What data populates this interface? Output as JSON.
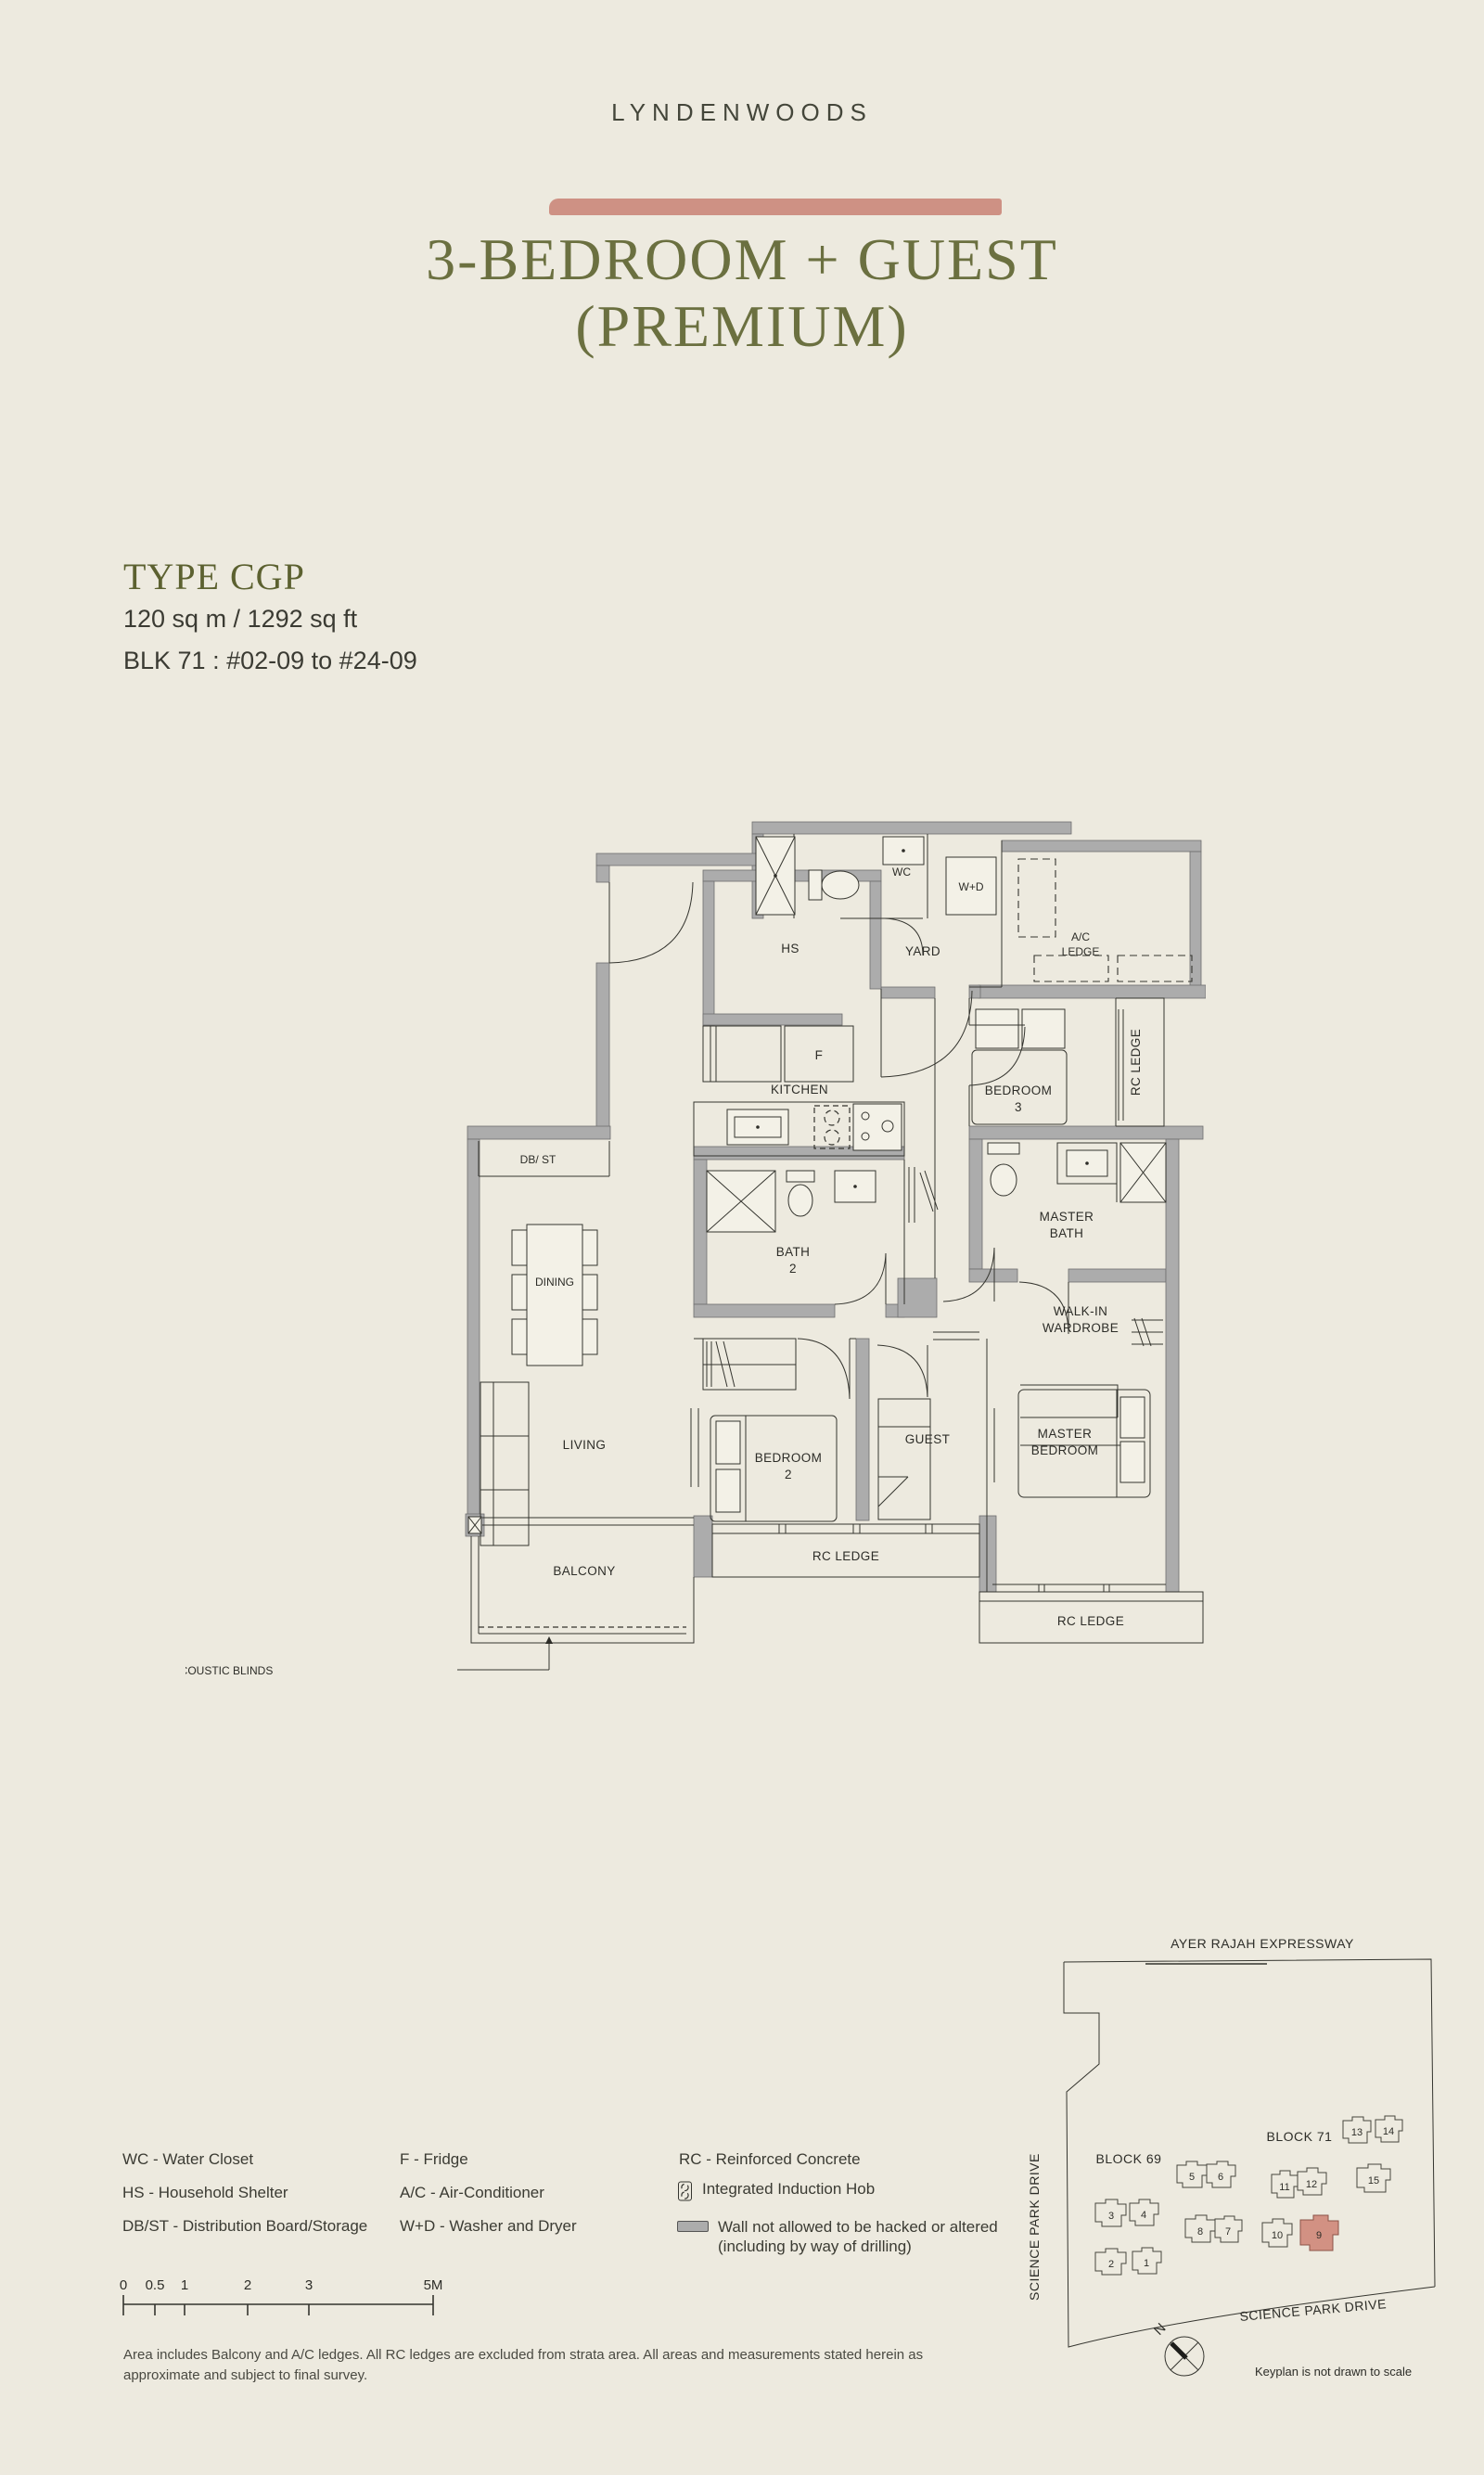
{
  "header": {
    "brand": "LYNDENWOODS",
    "title_line1": "3-BEDROOM + GUEST",
    "title_line2": "(PREMIUM)",
    "accent_color": "#CE9184"
  },
  "unit_info": {
    "type": "TYPE CGP",
    "area": "120 sq m / 1292 sq ft",
    "block": "BLK 71 : #02-09 to #24-09"
  },
  "floor_plan": {
    "labels": {
      "wc": "WC",
      "wd": "W+D",
      "yard": "YARD",
      "ac1": "A/C",
      "ac2": "LEDGE",
      "hs": "HS",
      "f": "F",
      "kitchen": "KITCHEN",
      "br3_1": "BEDROOM",
      "br3_2": "3",
      "rc_right": "RC LEDGE",
      "dbst": "DB/ ST",
      "bath2_1": "BATH",
      "bath2_2": "2",
      "mbath1": "MASTER",
      "mbath2": "BATH",
      "dining": "DINING",
      "wiw1": "WALK-IN",
      "wiw2": "WARDROBE",
      "living": "LIVING",
      "br2_1": "BEDROOM",
      "br2_2": "2",
      "guest": "GUEST",
      "mbr1": "MASTER",
      "mbr2": "BEDROOM",
      "balcony": "BALCONY",
      "rc_bottom": "RC LEDGE",
      "rc_bottom_right": "RC LEDGE",
      "acoustic": "ACOUSTIC BLINDS"
    },
    "wall_color": "#ACACAC"
  },
  "legend": {
    "wc": "WC - Water Closet",
    "hs": "HS - Household Shelter",
    "dbst": "DB/ST - Distribution Board/Storage",
    "f": "F - Fridge",
    "ac": "A/C - Air-Conditioner",
    "wd": "W+D - Washer and Dryer",
    "rc": "RC - Reinforced Concrete",
    "hob": "Integrated Induction Hob",
    "wall1": "Wall not allowed to be hacked or altered",
    "wall2": "(including by way of drilling)"
  },
  "scale_bar": {
    "t0": "0",
    "t05": "0.5",
    "t1": "1",
    "t2": "2",
    "t3": "3",
    "t5": "5M"
  },
  "notes": {
    "line1": "Area includes Balcony and A/C ledges. All RC ledges are excluded from strata area. All areas and measurements stated herein as",
    "line2": "approximate and subject to final survey."
  },
  "keyplan": {
    "expressway": "AYER RAJAH EXPRESSWAY",
    "road_left": "SCIENCE PARK DRIVE",
    "road_bottom": "SCIENCE PARK DRIVE",
    "block69": "BLOCK 69",
    "block71": "BLOCK 71",
    "north": "N",
    "note": "Keyplan is not drawn to scale",
    "highlighted_unit": "9",
    "highlight_color": "#D29183",
    "units": {
      "u1": "1",
      "u2": "2",
      "u3": "3",
      "u4": "4",
      "u5": "5",
      "u6": "6",
      "u7": "7",
      "u8": "8",
      "u9": "9",
      "u10": "10",
      "u11": "11",
      "u12": "12",
      "u13": "13",
      "u14": "14",
      "u15": "15"
    }
  }
}
